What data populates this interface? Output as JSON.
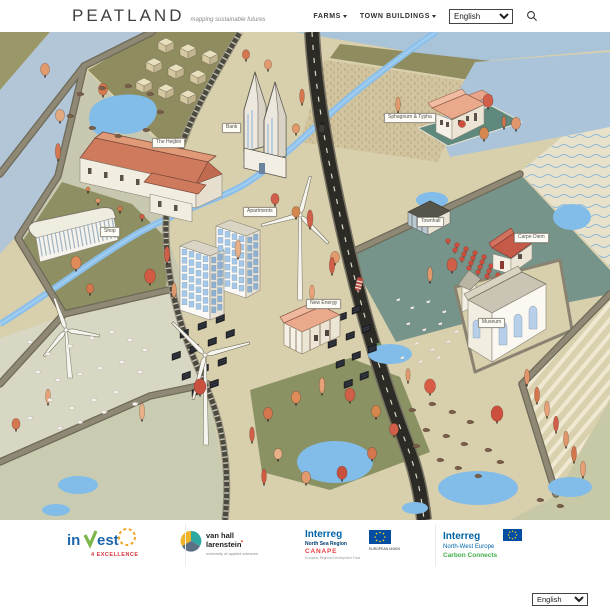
{
  "header": {
    "brand": "PEATLAND",
    "tagline": "mapping sustainable futures",
    "nav": [
      {
        "label": "FARMS",
        "has_dropdown": true
      },
      {
        "label": "TOWN BUILDINGS",
        "has_dropdown": true
      }
    ],
    "language_select": {
      "value": "English"
    },
    "search_icon": "magnifier"
  },
  "map": {
    "labels": {
      "farm_heijbin": "The Heijbin",
      "bank": "Bank",
      "apartments": "Apartments",
      "shop": "Shop",
      "new_energy": "New Energy",
      "sphagnum_typha": "Sphagnum & Typha",
      "townhall": "Townhall",
      "carpe_diem": "Carpe Diem",
      "museum": "Museum"
    },
    "palette": {
      "field_tan": "#d8cfad",
      "field_olive": "#8f8c5f",
      "field_blue": "#b2c6d8",
      "field_teal": "#77948a",
      "pond_blue": "#82bce8",
      "road_gray": "#8a8371",
      "asphalt": "#2c2b26",
      "tree_orange": "#e09a6e",
      "tree_red": "#cf5f48"
    }
  },
  "footer": {
    "logos": [
      {
        "id": "invest4excellence",
        "part1": "in",
        "part2": "est",
        "sub": "4 EXCELLENCE"
      },
      {
        "id": "van-hall-larenstein",
        "line1": "van hall",
        "line2": "larenstein",
        "line3": "university of applied sciences"
      },
      {
        "id": "interreg-north-sea-region",
        "line1": "Interreg",
        "line2": "North Sea Region",
        "line3": "CANAPE",
        "line4": "European Regional Development Fund",
        "line5": "EUROPEAN UNION"
      },
      {
        "id": "interreg-nwe-carbon-connects",
        "line1": "Interreg",
        "line2": "North-West Europe",
        "line3": "Carbon Connects"
      }
    ],
    "language_select": {
      "value": "English"
    }
  }
}
